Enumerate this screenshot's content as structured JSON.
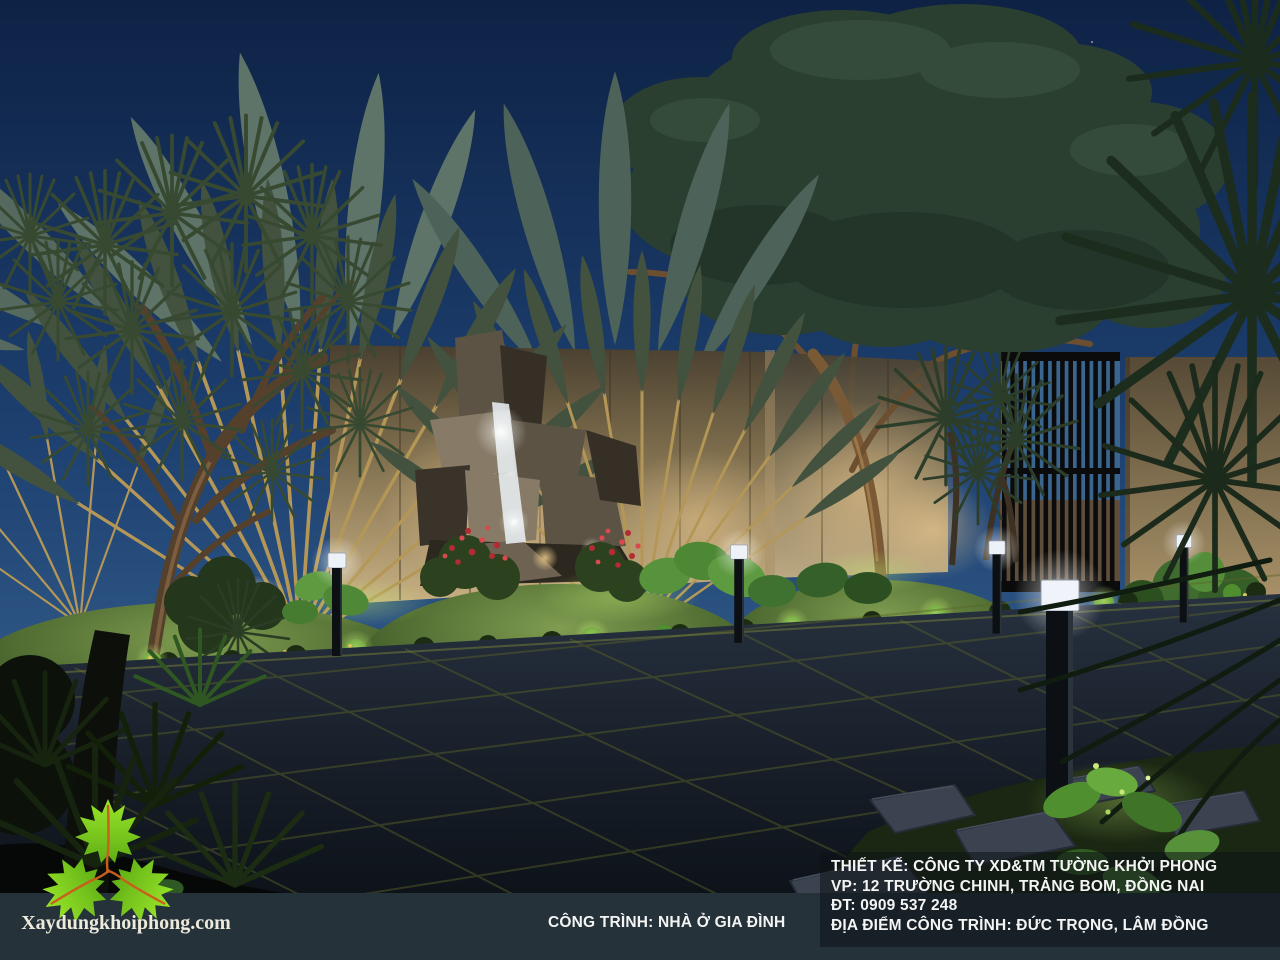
{
  "branding": {
    "website_label": "Xaydungkhoiphong.com",
    "logo_icon": "three-maple-leaves"
  },
  "footer": {
    "project_label": "CÔNG TRÌNH: NHÀ Ở GIA ĐÌNH",
    "lines": [
      "THIẾT KẾ: CÔNG TY XD&TM TƯỜNG KHỞI PHONG",
      "VP: 12 TRƯỜNG CHINH, TRẢNG BOM, ĐỒNG NAI",
      "ĐT: 0909 537 248",
      "ĐỊA ĐIỂM CÔNG TRÌNH: ĐỨC TRỌNG, LÂM ĐỒNG"
    ]
  },
  "colors": {
    "sky_top": "#0e2245",
    "sky_mid": "#1d4070",
    "sky_horizon": "#4a7aa5",
    "strip_bg": "#25323a",
    "panel_bg": "rgba(12,19,21,0.55)",
    "text_light": "#f4f4f4",
    "logo_text": "#eeeadb",
    "leaf_green_light": "#9ae62a",
    "leaf_green_dark": "#5fae14",
    "leaf_stem": "#c85f1c",
    "fan_stem": "#b49756",
    "fan_leaf": "#42523f",
    "wall_lit": "#c9b183",
    "pave_line": "#5c6428"
  }
}
